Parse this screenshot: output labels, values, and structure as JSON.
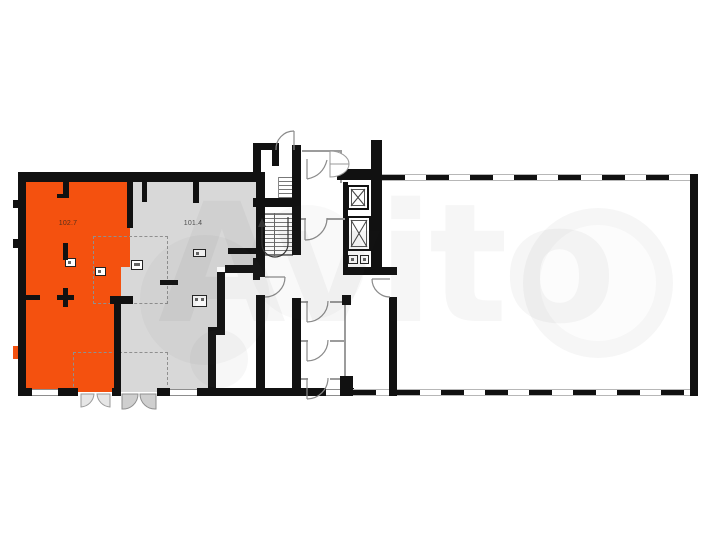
{
  "plan": {
    "rooms": [
      {
        "id": "unit-102-7",
        "area_label": "102.7",
        "highlighted": true
      },
      {
        "id": "unit-101-4",
        "area_label": "101.4",
        "highlighted": false
      }
    ]
  },
  "watermark": {
    "text": "Avito"
  },
  "palette": {
    "highlight_room": "#f4510f",
    "secondary_room": "#d8d8d8",
    "wall": "#111111",
    "label_on_highlight": "#58301a",
    "label_on_secondary": "#4f4f4f",
    "door_leaf_light": "#e6e6e6",
    "door_leaf_gray": "#cfcfcf"
  }
}
